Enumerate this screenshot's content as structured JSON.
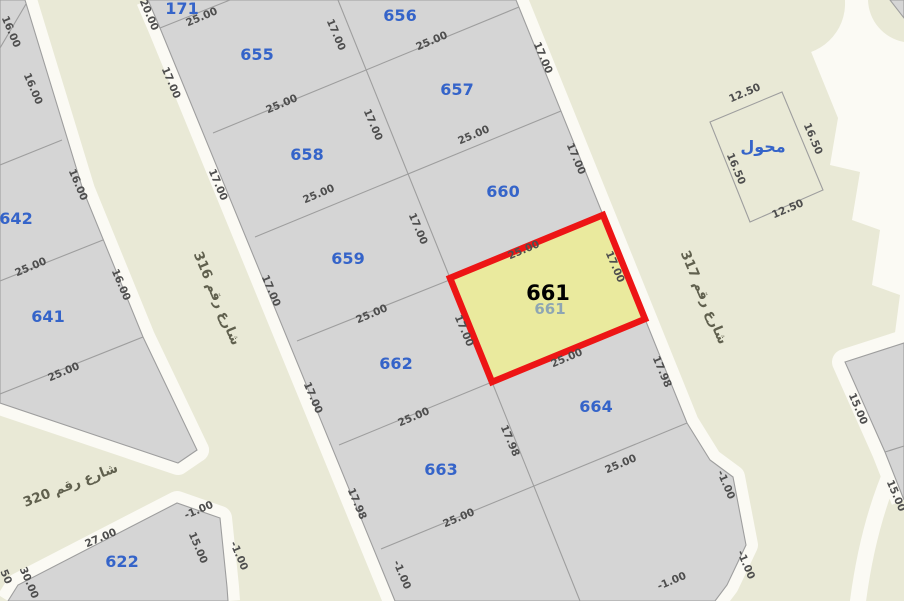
{
  "map_type": "cadastral-parcel-map",
  "colors": {
    "background_street": "#e9e9d6",
    "sidewalk": "#fbfaf4",
    "parcel_fill": "#d5d5d5",
    "parcel_stroke": "#9e9e9e",
    "highlight_fill": "#eaea9e",
    "highlight_stroke": "#ed1515",
    "parcel_number": "#3564c9",
    "dimension_text": "#4e4e4e",
    "street_label": "#60604e",
    "selected_number": "#000000"
  },
  "selected_parcel": {
    "number": "661",
    "ghost_number": "661",
    "dim_top": "25.00",
    "dim_bottom": "25.00",
    "dim_left": "17.00",
    "dim_right": "17.00"
  },
  "streets": {
    "s316": "شارع رقم 316",
    "s317": "شارع رقم 317",
    "s320": "شارع رقم 320"
  },
  "parcels": [
    {
      "id": "171",
      "label": "171"
    },
    {
      "id": "655",
      "label": "655"
    },
    {
      "id": "656",
      "label": "656"
    },
    {
      "id": "657",
      "label": "657"
    },
    {
      "id": "658",
      "label": "658"
    },
    {
      "id": "659",
      "label": "659"
    },
    {
      "id": "660",
      "label": "660"
    },
    {
      "id": "662",
      "label": "662"
    },
    {
      "id": "663",
      "label": "663"
    },
    {
      "id": "664",
      "label": "664"
    },
    {
      "id": "641",
      "label": "641"
    },
    {
      "id": "642",
      "label": "642"
    },
    {
      "id": "622",
      "label": "622"
    },
    {
      "id": "transformer",
      "label": "محول"
    }
  ],
  "dims": [
    "25.00",
    "25.00",
    "25.00",
    "25.00",
    "25.00",
    "25.00",
    "25.00",
    "25.00",
    "25.00",
    "25.00",
    "25.00",
    "25.00",
    "25.00",
    "27.00",
    "-1.00",
    "-1.00",
    "12.50",
    "12.50",
    "20.00",
    "17.00",
    "17.00",
    "17.00",
    "17.00",
    "17.98",
    "-1.00",
    "17.00",
    "17.00",
    "17.00",
    "17.98",
    "17.00",
    "17.00",
    "17.00",
    "17.00",
    "17.98",
    "16.00",
    "16.00",
    "16.00",
    "16.00",
    "30.00",
    "15.00",
    "-1.00",
    "-1.00",
    "-1.00",
    "16.50",
    "16.50",
    "15.00",
    "15.00",
    "50"
  ]
}
